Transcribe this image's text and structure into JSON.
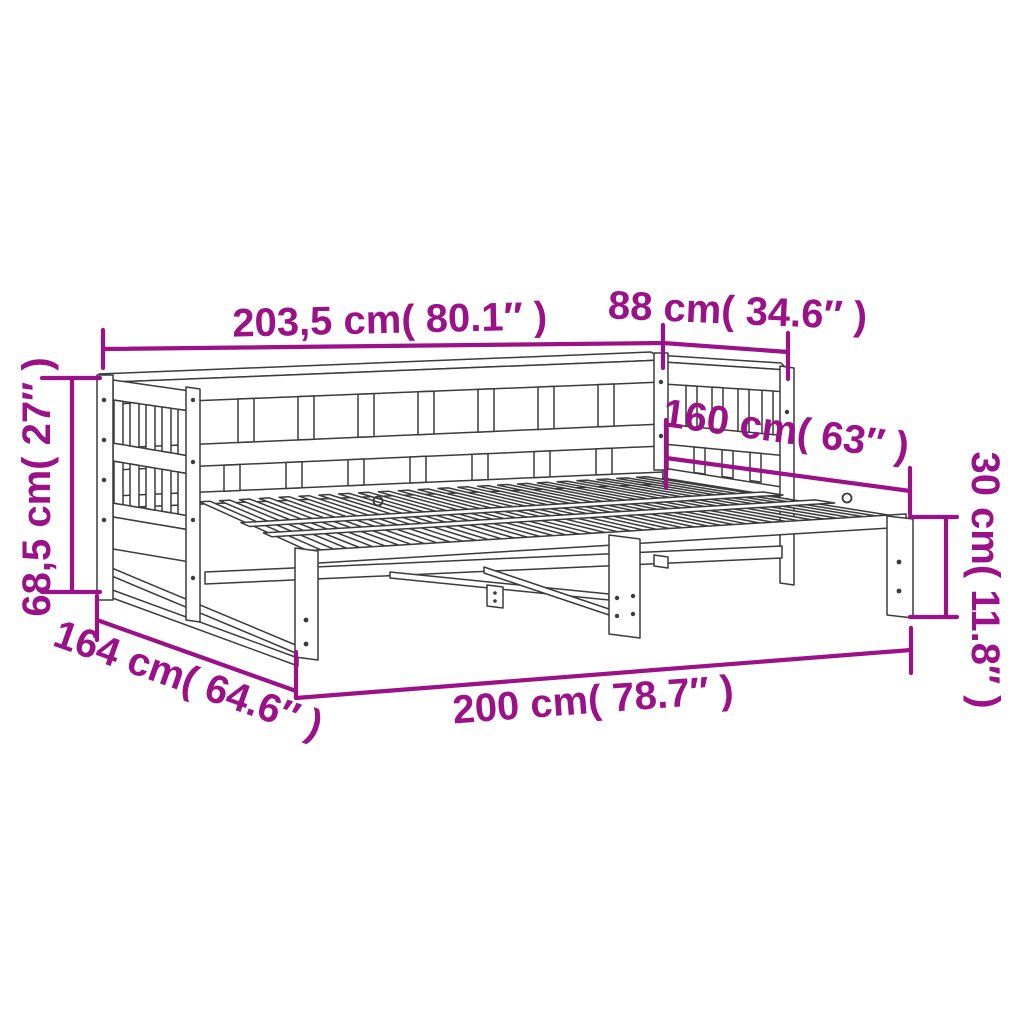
{
  "theme": {
    "accent": "#9a1188",
    "line": "#3b3b3b",
    "bg": "#ffffff"
  },
  "dimensions": {
    "length_overall": {
      "label": "203,5 cm( 80.1″ )",
      "cm": "203,5",
      "inches": "80.1"
    },
    "depth_side": {
      "label": "88 cm( 34.6″ )",
      "cm": "88",
      "inches": "34.6"
    },
    "height_overall": {
      "label": "68,5 cm( 27″ )",
      "cm": "68,5",
      "inches": "27"
    },
    "width_extended": {
      "label": "160 cm( 63″ )",
      "cm": "160",
      "inches": "63"
    },
    "trundle_height": {
      "label": "30 cm( 11.8″ )",
      "cm": "30",
      "inches": "11.8"
    },
    "depth_extended": {
      "label": "164 cm( 64.6″ )",
      "cm": "164",
      "inches": "64.6"
    },
    "trundle_length": {
      "label": "200 cm( 78.7″ )",
      "cm": "200",
      "inches": "78.7"
    }
  }
}
